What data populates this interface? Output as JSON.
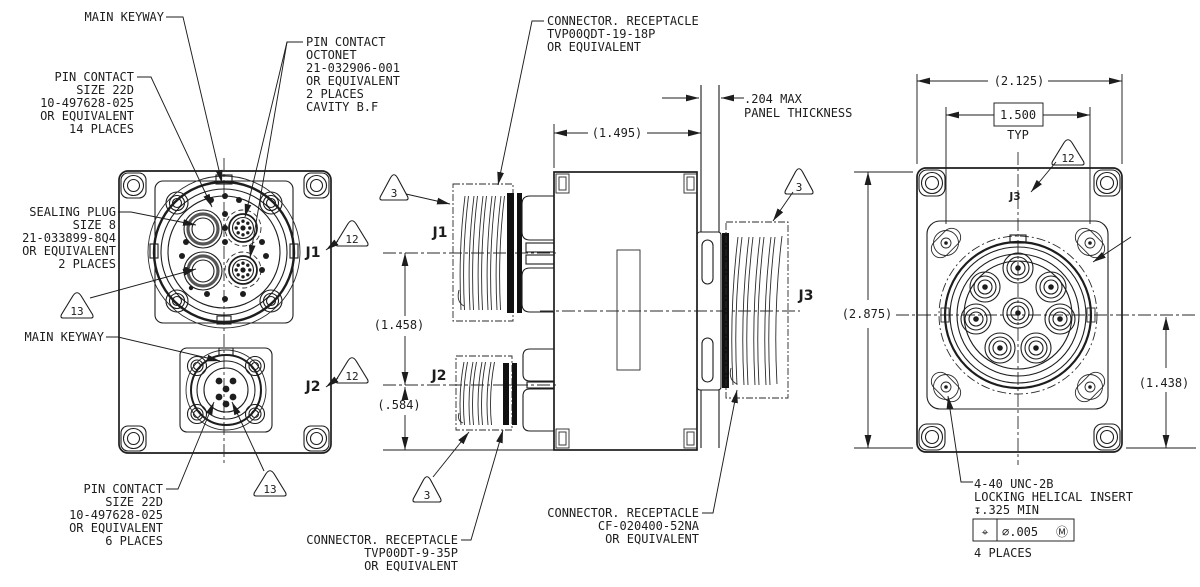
{
  "drawing": {
    "callouts": {
      "main_keyway_top": {
        "lines": [
          "MAIN KEYWAY"
        ]
      },
      "pin_contact_14": {
        "lines": [
          "PIN CONTACT",
          "SIZE 22D",
          "10-497628-025",
          "OR EQUIVALENT",
          "14 PLACES"
        ]
      },
      "pin_contact_octonet": {
        "lines": [
          "PIN CONTACT",
          "OCTONET",
          "21-032906-001",
          "OR EQUIVALENT",
          "2 PLACES",
          "CAVITY B.F"
        ]
      },
      "sealing_plug": {
        "lines": [
          "SEALING PLUG",
          "SIZE 8",
          "21-033899-8Q4",
          "OR EQUIVALENT",
          "2 PLACES"
        ]
      },
      "main_keyway_bottom": {
        "lines": [
          "MAIN KEYWAY"
        ]
      },
      "pin_contact_6": {
        "lines": [
          "PIN CONTACT",
          "SIZE 22D",
          "10-497628-025",
          "OR EQUIVALENT",
          "6 PLACES"
        ]
      },
      "receptacle_j1": {
        "lines": [
          "CONNECTOR. RECEPTACLE",
          "TVP00QDT-19-18P",
          "OR EQUIVALENT"
        ]
      },
      "receptacle_j2": {
        "lines": [
          "CONNECTOR. RECEPTACLE",
          "TVP00DT-9-35P",
          "OR EQUIVALENT"
        ]
      },
      "receptacle_j3": {
        "lines": [
          "CONNECTOR. RECEPTACLE",
          "CF-020400-52NA",
          "OR EQUIVALENT"
        ]
      },
      "panel": {
        "lines": [
          ".204 MAX",
          "PANEL THICKNESS"
        ]
      },
      "insert_note": {
        "line1": "4-40 UNC-2B",
        "line2": "LOCKING HELICAL INSERT",
        "line3": "↧.325 MIN",
        "fcf_symbol": "⌖",
        "fcf_tolerance": "⌀.005",
        "fcf_modifier": "Ⓜ",
        "line5": "4 PLACES"
      }
    },
    "dimensions": {
      "body_length": "(1.495)",
      "j1_j2_spacing": "(1.458)",
      "j2_base": "(.584)",
      "plate_width": "(2.125)",
      "screw_spacing": "1.500",
      "screw_spacing_qual": "TYP",
      "plate_height": "(2.875)",
      "center_to_base": "(1.438)"
    },
    "connectors": {
      "j1": "J1",
      "j2": "J2",
      "j3": "J3"
    },
    "flags": {
      "f3": "3",
      "f12": "12",
      "f13": "13"
    },
    "colors": {
      "line": "#1d1d1d",
      "background": "#ffffff"
    }
  }
}
